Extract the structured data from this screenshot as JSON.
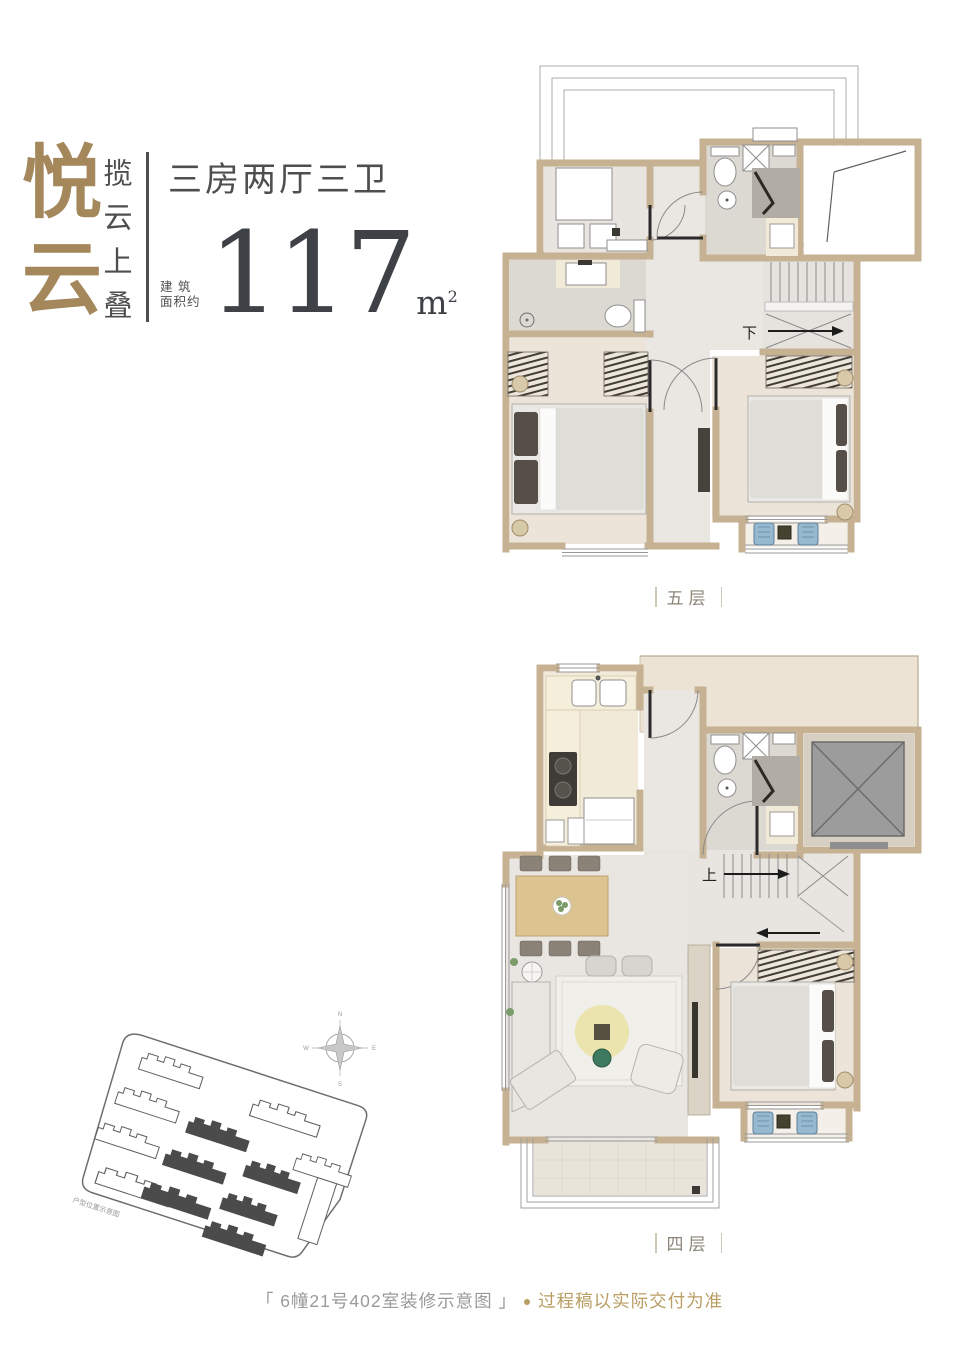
{
  "header": {
    "brand_vertical": "悦云",
    "tagline_vertical": "揽云上叠",
    "layout_spec": "三房两厅三卫",
    "area_label": "建 筑\n面积约",
    "area_value": "117",
    "area_unit_base": "m",
    "area_unit_sup": "2"
  },
  "plans": {
    "upper": {
      "label": "五层",
      "stair_direction": "下"
    },
    "lower": {
      "label": "四层",
      "stair_direction": "上"
    }
  },
  "site_plan": {
    "note": "户型位置示意图",
    "compass": {
      "n": "N",
      "e": "E",
      "s": "S",
      "w": "W"
    }
  },
  "footer": {
    "caption": "「 6幢21号402室装修示意图 」",
    "bullet": "●",
    "disclaimer": "过程稿以实际交付为准"
  },
  "colors": {
    "brand_gold": "#a4885c",
    "text_dark": "#4a4a4a",
    "number_dark": "#3e4246",
    "wall_tan": "#c6b193",
    "accent_gold": "#b99d62",
    "floor_gray": "#e9e6e2",
    "floor_wood": "#ece4d9",
    "elevator_gray": "#9c9c9c",
    "balcony_chair_blue": "#96b9d0"
  }
}
